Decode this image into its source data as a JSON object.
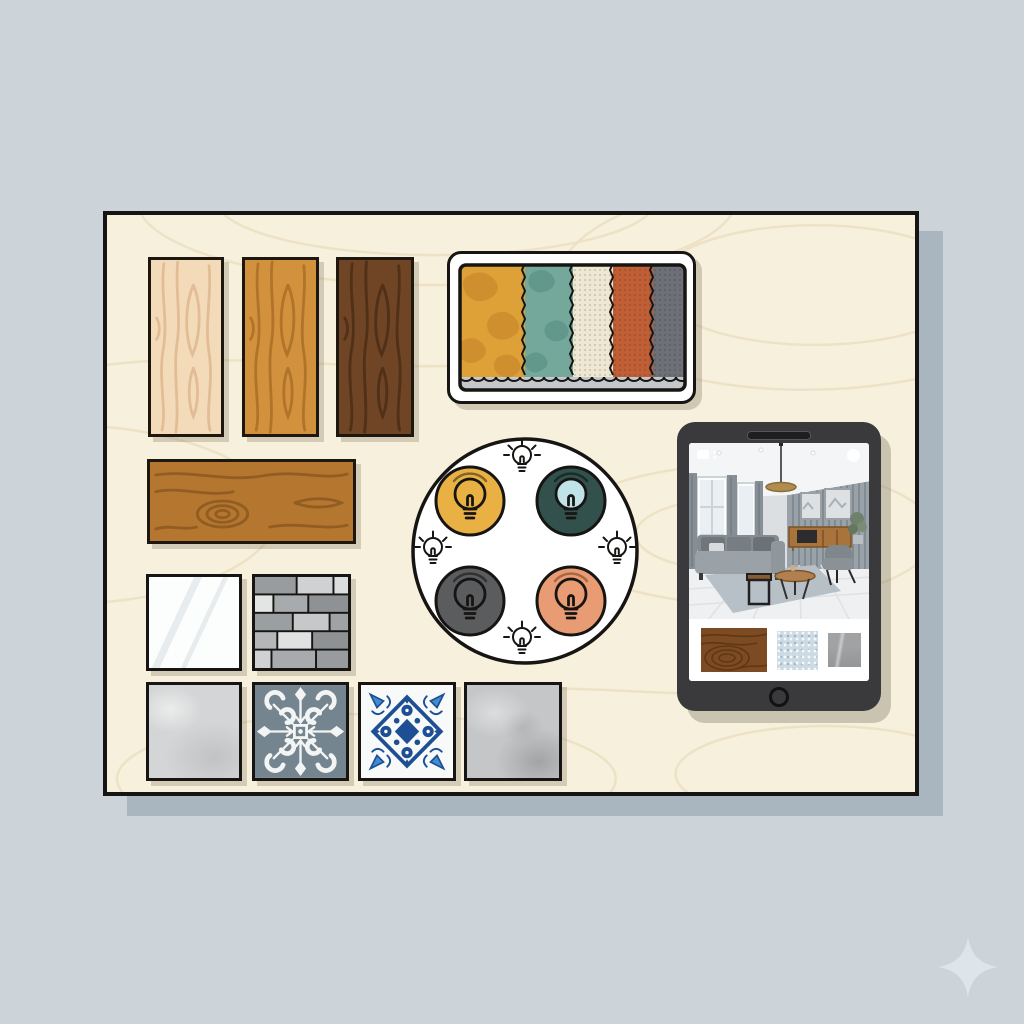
{
  "scene": {
    "description": "interior design mood board illustration",
    "background": "#ccd4da",
    "board": {
      "surface": "#f7f0dc",
      "grain": "#ecdfc2",
      "border": "#171513",
      "shadow": "#a9b6c0"
    },
    "sparkle_color": "#dee5ea"
  },
  "wood_samples": {
    "vertical": [
      {
        "name": "light pine plank",
        "base": "#f3dbb9",
        "grain": "#d3a377"
      },
      {
        "name": "golden oak plank",
        "base": "#d2913c",
        "grain": "#a66d26"
      },
      {
        "name": "dark walnut plank",
        "base": "#6f4526",
        "grain": "#4c2d16"
      }
    ],
    "horizontal": {
      "name": "caramel oak board",
      "base": "#b5772f",
      "grain": "#8a561f"
    }
  },
  "fabric_card": {
    "card_bg": "#ffffff",
    "border": "#171513",
    "base_strip": "#c4c8cb",
    "swatches": [
      {
        "name": "mustard patterned fabric",
        "color": "#dda138",
        "accent": "#cd8d2d"
      },
      {
        "name": "teal patterned fabric",
        "color": "#74a89b",
        "accent": "#5f9488"
      },
      {
        "name": "cream woven fabric",
        "color": "#eee7d2",
        "accent": "#c9bd9e"
      },
      {
        "name": "terracotta woven fabric",
        "color": "#c05f36",
        "accent": "#a84d29"
      },
      {
        "name": "charcoal woven fabric",
        "color": "#6d7076",
        "accent": "#55585e"
      }
    ]
  },
  "lighting_palette": {
    "disc_bg": "#ffffff",
    "outline": "#171513",
    "options": [
      {
        "name": "warm yellow light",
        "color": "#e9b143"
      },
      {
        "name": "deep teal light",
        "color": "#32514c",
        "glass": "#c0e3e7"
      },
      {
        "name": "charcoal gray light",
        "color": "#5b5c5e"
      },
      {
        "name": "soft coral light",
        "color": "#e99b73"
      }
    ]
  },
  "tablet": {
    "body": "#3a3a3c",
    "screen_bg": "#ffffff",
    "thumbnails": [
      {
        "name": "walnut wood texture",
        "color": "#7c4a23"
      },
      {
        "name": "blue speckled fabric",
        "color": "#ccdae4"
      },
      {
        "name": "gray stone texture",
        "color": "#a0a2a4"
      }
    ]
  },
  "tiles": [
    {
      "name": "mirror tile",
      "color": "#fcfdfd"
    },
    {
      "name": "gray brick mosaic tile",
      "grout": "#171513",
      "brick_colors": [
        "#999c9e",
        "#cfd1d2",
        "#dcdddd",
        "#e3e4e4",
        "#a8abad",
        "#8f9294",
        "#b4b6b8"
      ]
    },
    {
      "name": "light concrete tile",
      "color": "#d4d5d6"
    },
    {
      "name": "gray ornament cement tile",
      "base": "#75858f",
      "pattern": "#f3f5f5"
    },
    {
      "name": "blue majolica tile",
      "base": "#f8f9f9",
      "pattern": "#1e4f95",
      "accent": "#3e8ed0"
    },
    {
      "name": "warm concrete tile",
      "color": "#c5c6c7"
    }
  ]
}
